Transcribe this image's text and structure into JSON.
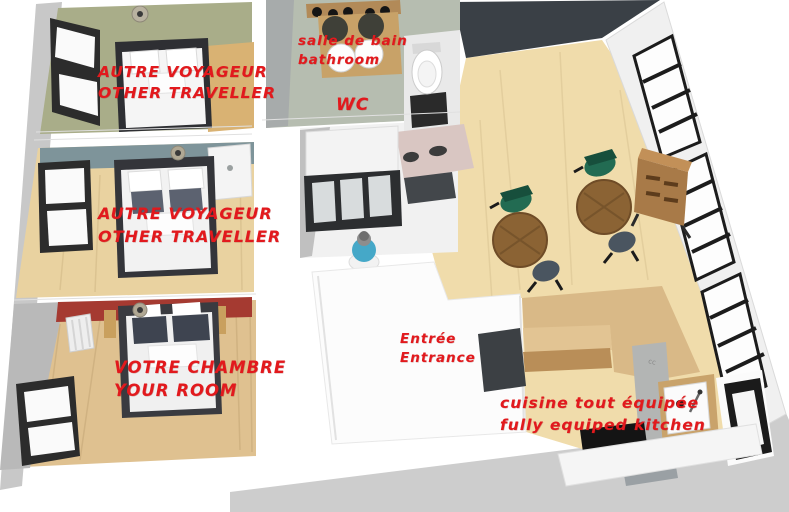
{
  "title": "3D apartment floor plan",
  "labels": {
    "bedroom1": {
      "line1": "AUTRE VOYAGEUR",
      "line2": "OTHER TRAVELLER"
    },
    "bedroom2": {
      "line1": "AUTRE VOYAGEUR",
      "line2": "OTHER TRAVELLER"
    },
    "bedroom3": {
      "line1": "VOTRE CHAMBRE",
      "line2": "YOUR ROOM"
    },
    "bathroom": {
      "line1": "salle de bain",
      "line2": "bathroom"
    },
    "wc": {
      "line1": "WC"
    },
    "entrance": {
      "line1": "Entrée",
      "line2": "Entrance"
    },
    "kitchen": {
      "line1": "cuisine tout équipée",
      "line2": "fully equiped kitchen"
    },
    "wall_mark": "cc"
  },
  "colors": {
    "label_red": "#e2191d",
    "bedroom1_floor": "#a9ad89",
    "bedroom2_wall": "#7e949a",
    "bedroom2_floor": "#e9d2a0",
    "bedroom3_wall": "#a53a31",
    "bedroom3_floor": "#dfc190",
    "living_floor": "#f0dcab",
    "living_wall_dark": "#3a4046",
    "bathroom_floor": "#b6bdb0",
    "kitchen_wood": "#c9a36b",
    "table_wood": "#8b6334",
    "chair_green": "#226b52",
    "chair_gray": "#4a5560",
    "person_blue": "#45a8c8",
    "pink_wall": "#d9c6c2",
    "exterior_gray": "#cdcdcd"
  },
  "scene": {
    "type": "3d-floor-plan-render",
    "rooms": [
      {
        "name": "bedroom-1",
        "label_fr": "AUTRE VOYAGEUR",
        "label_en": "OTHER TRAVELLER",
        "furniture": [
          "double-bed",
          "window",
          "ceiling-light",
          "side-desk"
        ]
      },
      {
        "name": "bedroom-2",
        "label_fr": "AUTRE VOYAGEUR",
        "label_en": "OTHER TRAVELLER",
        "furniture": [
          "double-bed",
          "window",
          "ceiling-light",
          "vanity-sink"
        ]
      },
      {
        "name": "bedroom-3",
        "label_fr": "VOTRE CHAMBRE",
        "label_en": "YOUR ROOM",
        "furniture": [
          "double-bed",
          "window",
          "ceiling-light",
          "radiator"
        ]
      },
      {
        "name": "bathroom",
        "label_fr": "salle de bain",
        "label_en": "bathroom",
        "furniture": [
          "double-vanity",
          "two-mirrors",
          "wall-lamps",
          "two-sinks"
        ]
      },
      {
        "name": "wc",
        "label_fr": "WC",
        "label_en": "WC",
        "furniture": [
          "toilet",
          "shower",
          "person-figure"
        ]
      },
      {
        "name": "entrance",
        "label_fr": "Entrée",
        "label_en": "Entrance",
        "furniture": [
          "wardrobe"
        ]
      },
      {
        "name": "living-room",
        "label_fr": "",
        "label_en": "",
        "furniture": [
          "dining-table-1",
          "dining-table-2",
          "green-chair-1",
          "green-chair-2",
          "gray-chair-1",
          "gray-chair-2",
          "sideboard",
          "plant",
          "windows"
        ]
      },
      {
        "name": "kitchen",
        "label_fr": "cuisine tout équipée",
        "label_en": "fully equiped kitchen",
        "furniture": [
          "island-counter",
          "sink",
          "cooktop",
          "oven",
          "kitchen-window",
          "base-cabinets"
        ]
      }
    ]
  }
}
